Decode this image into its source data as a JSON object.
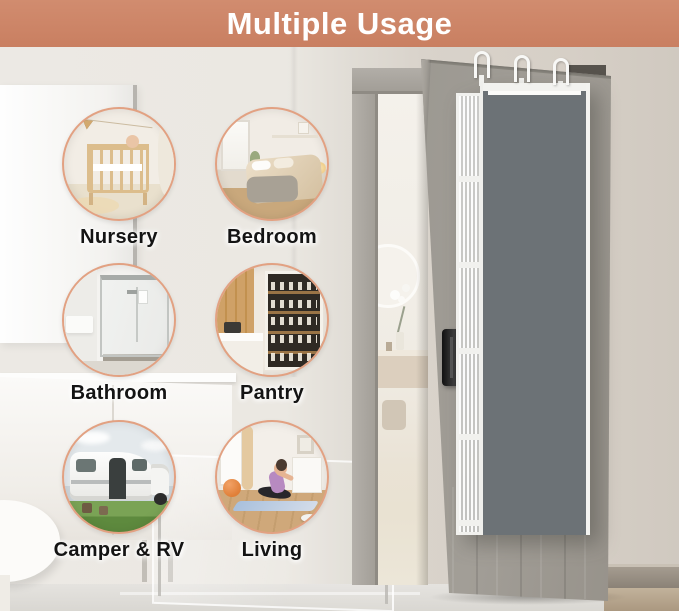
{
  "header": {
    "title": "Multiple Usage"
  },
  "usages": [
    {
      "id": "nursery",
      "label": "Nursery"
    },
    {
      "id": "bedroom",
      "label": "Bedroom"
    },
    {
      "id": "bathroom",
      "label": "Bathroom"
    },
    {
      "id": "pantry",
      "label": "Pantry"
    },
    {
      "id": "camper-rv",
      "label": "Camper & RV"
    },
    {
      "id": "living",
      "label": "Living"
    }
  ],
  "door_scene": {
    "door_state": "open",
    "hooks": 3,
    "organizer": {
      "style": "gray fabric over-door organizer with white trim, mesh side and clear windows",
      "pockets": [
        {
          "kind": "top-shelf",
          "contents": "teddy bears (brown and pink)"
        },
        {
          "kind": "clear-window",
          "contents": "teddy bears"
        },
        {
          "kind": "open-pocket",
          "contents": "books and folders"
        },
        {
          "kind": "clear-window",
          "contents": "white books"
        },
        {
          "kind": "open-pocket",
          "contents": "snack bags"
        },
        {
          "kind": "clear-window",
          "contents": "snack box"
        },
        {
          "kind": "open-pocket",
          "contents": "towels"
        },
        {
          "kind": "clear-window",
          "contents": "rolled towels"
        },
        {
          "kind": "open-pocket",
          "contents": "storage boxes"
        },
        {
          "kind": "clear-window",
          "contents": "baby product boxes"
        }
      ]
    }
  },
  "palette": {
    "header_bg": "#cd8568",
    "circle_border": "#e2a182",
    "door_gray": "#99968f",
    "frame_gray": "#aaa69f",
    "organizer_gray": "#6c7276",
    "organizer_trim": "#f2f2ef",
    "wall_left": "#ebe8e2",
    "wall_right": "#d6cfc6",
    "floor": "#dcd9d3"
  }
}
